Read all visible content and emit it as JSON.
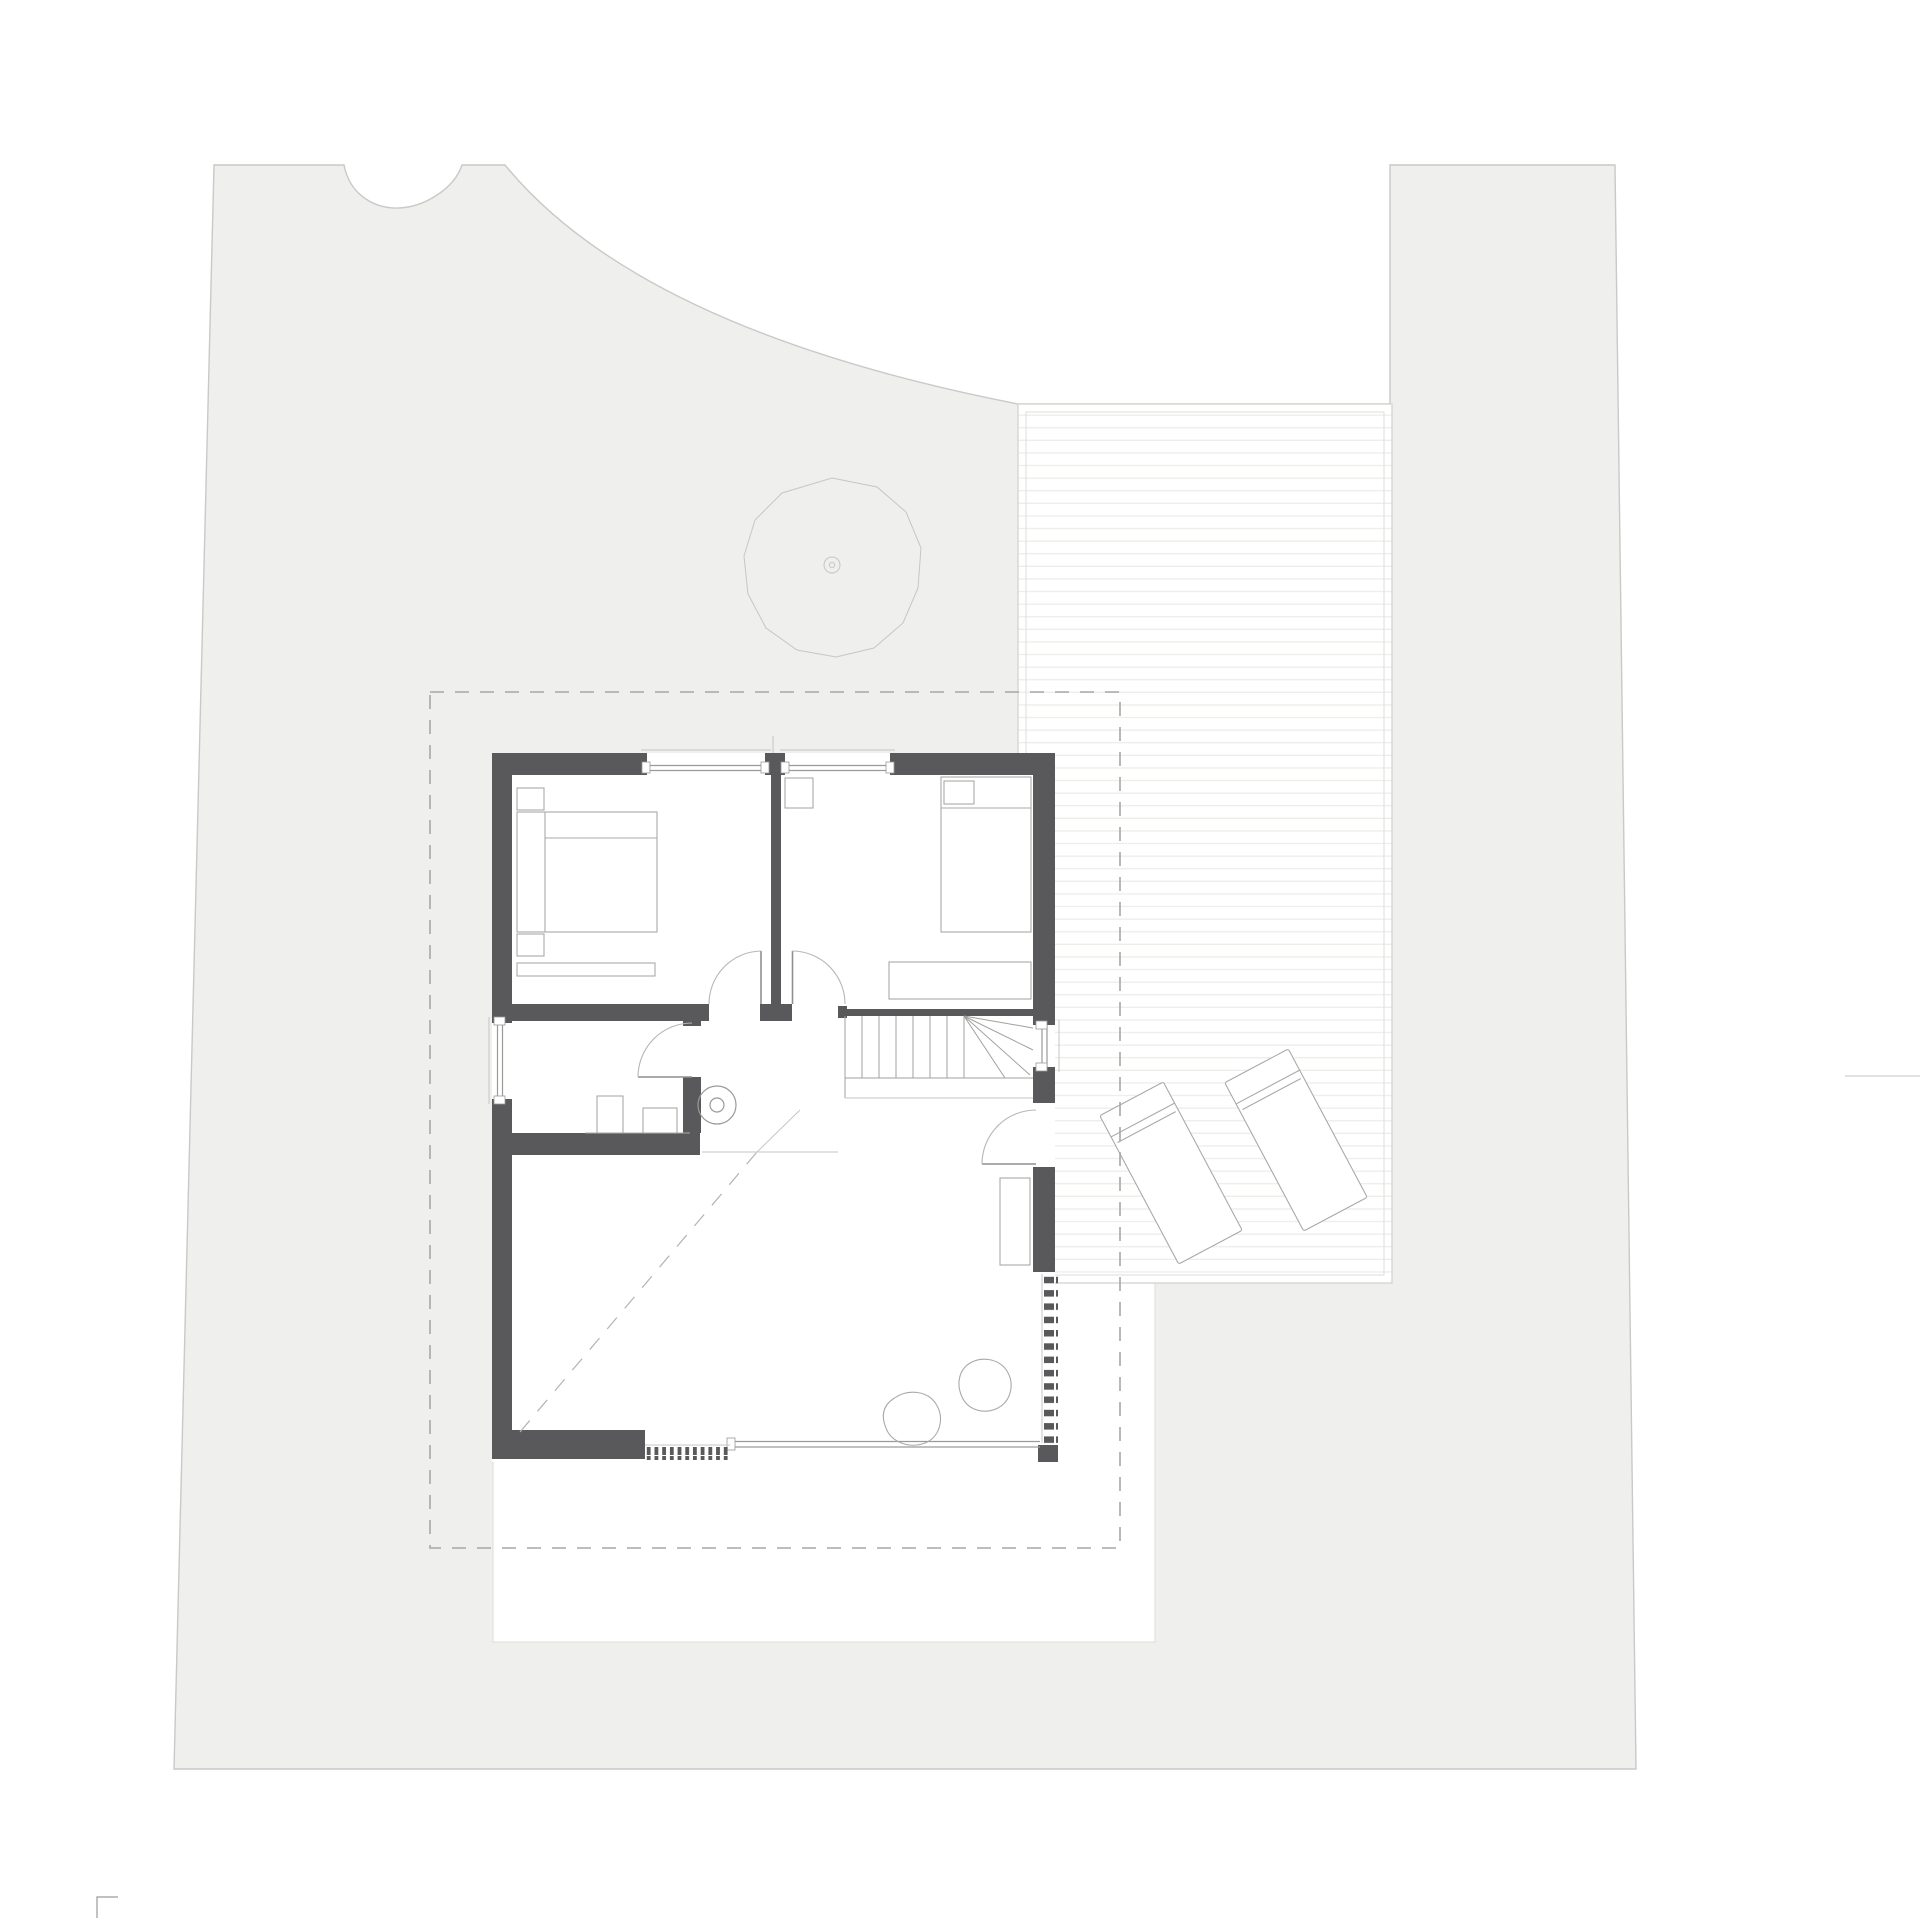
{
  "meta": {
    "kind": "architectural floor plan / site plan drawing",
    "visible_text": "",
    "page_background": "#ffffff"
  },
  "colors": {
    "site": "#efefed",
    "site_boundary": "#c9c9c7",
    "wall": "#59595b",
    "white": "#ffffff",
    "deck_border": "#d6d6d3",
    "deck_plank": "#ededea",
    "thin_line": "#9a9a98",
    "light_line": "#c6c6c4",
    "dash_line": "#a7a7a4",
    "furniture_line": "#a9a9a7"
  },
  "inventory": {
    "plot_areas": [
      "main-lawn",
      "right-strip-lawn",
      "white-notch",
      "white-courtyard"
    ],
    "tree_count": 1,
    "bush_count": 1,
    "deck": {
      "loungers": 2,
      "planked": true
    },
    "house": {
      "bedrooms": 2,
      "bathrooms": 1,
      "living_room": 1,
      "hall_with_stairs": 1,
      "windows": 4,
      "glass_front": 1,
      "exterior_doors": 1,
      "interior_doors": 3,
      "stairs": {
        "straight_treads": 7,
        "winder_lines": 4
      },
      "radiators": 1,
      "flue_circle": 1,
      "plants": 2
    },
    "roof_overhang_outline": "dashed rectangle",
    "boundary_marks": 2
  }
}
